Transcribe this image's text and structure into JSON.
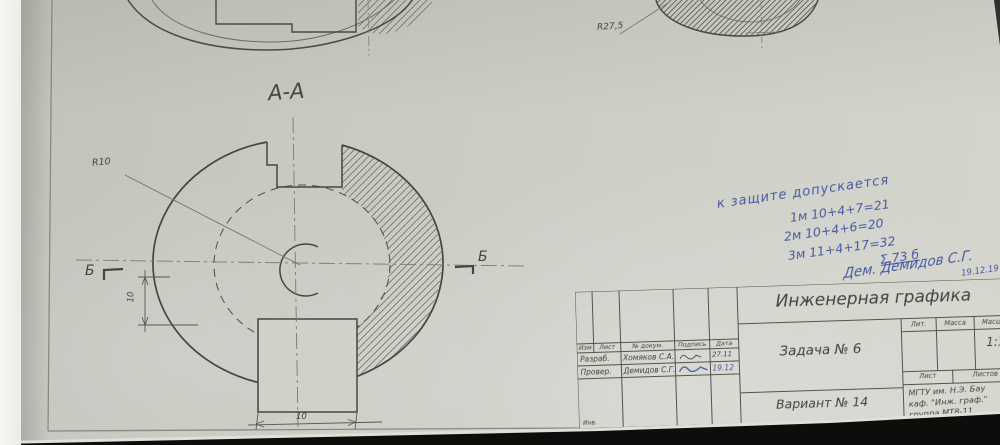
{
  "photo": {
    "paper_color": "#cbcdc5",
    "ink_color": "#3a4c9c",
    "pencil_color": "#45433d"
  },
  "drawing": {
    "section_label": "А-А",
    "radius_label_small": "R10",
    "radius_label_top": "R27,5",
    "dim_vertical": "10",
    "dim_bottom": "10",
    "cut_label_left": "Б",
    "cut_label_right": "Б"
  },
  "notes": {
    "line1": "к защите допускается",
    "line2": "1м 10+4+7=21",
    "line3": "2м 10+4+6=20",
    "line4": "3м 11+4+17=32",
    "sum": "Σ 73 б",
    "signature": "Дем. Демидов С.Г.",
    "date": "19.12.19"
  },
  "title_block": {
    "doc_title": "Инженерная графика",
    "task": "Задача № 6",
    "variant": "Вариант № 14",
    "lit_header": "Лит.",
    "mass_header": "Масса",
    "scale_header": "Масшт.",
    "scale_value": "1:1",
    "sheet_header": "Лист",
    "sheets_header": "Листов",
    "col_headers": {
      "izm": "Изм",
      "list": "Лист",
      "doc": "№ докум.",
      "sign": "Подпись",
      "date": "Дата"
    },
    "rows": [
      {
        "role": "Разраб.",
        "name": "Хомяков С.А.",
        "date": "27.11"
      },
      {
        "role": "Провер.",
        "name": "Демидов С.Г.",
        "date": "19.12"
      }
    ],
    "org_line1": "МГТУ им. Н.Э. Бау",
    "org_line2": "каф. \"Инж. граф.\"",
    "org_line3": "группа МТ8-11",
    "bottom_left_label": "Инв."
  }
}
